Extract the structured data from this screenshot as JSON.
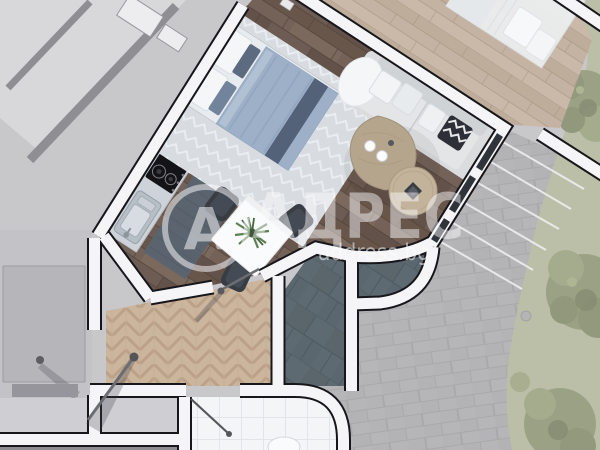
{
  "watermark": {
    "logo_letter": "А",
    "brand": "АДРЕС",
    "domain": "address.bg"
  },
  "palette": {
    "bg": "#c8c8cb",
    "wall_white": "#f5f5f7",
    "wall_outline": "#17171b",
    "floor_wood": "#6d5c53",
    "floor_wood_neighbor": "#c4b3a2",
    "floor_parquet": "#cbb59c",
    "paving": "#b6b6b8",
    "terrace_slate": "#5e6a71",
    "bathroom_tile": "#f3f5f7",
    "grass": "#bcbfa8",
    "tree_canopy": "#99a083",
    "bed_duvet": "#9db0c8",
    "bed_rug": "#d8dce1",
    "kitchen_rug": "#5a6470",
    "sofa": "#e3e5e7",
    "coffee_table": "#b5a58d",
    "chair": "#383d44",
    "watermark_color": "rgba(252,252,254,0.52)"
  }
}
